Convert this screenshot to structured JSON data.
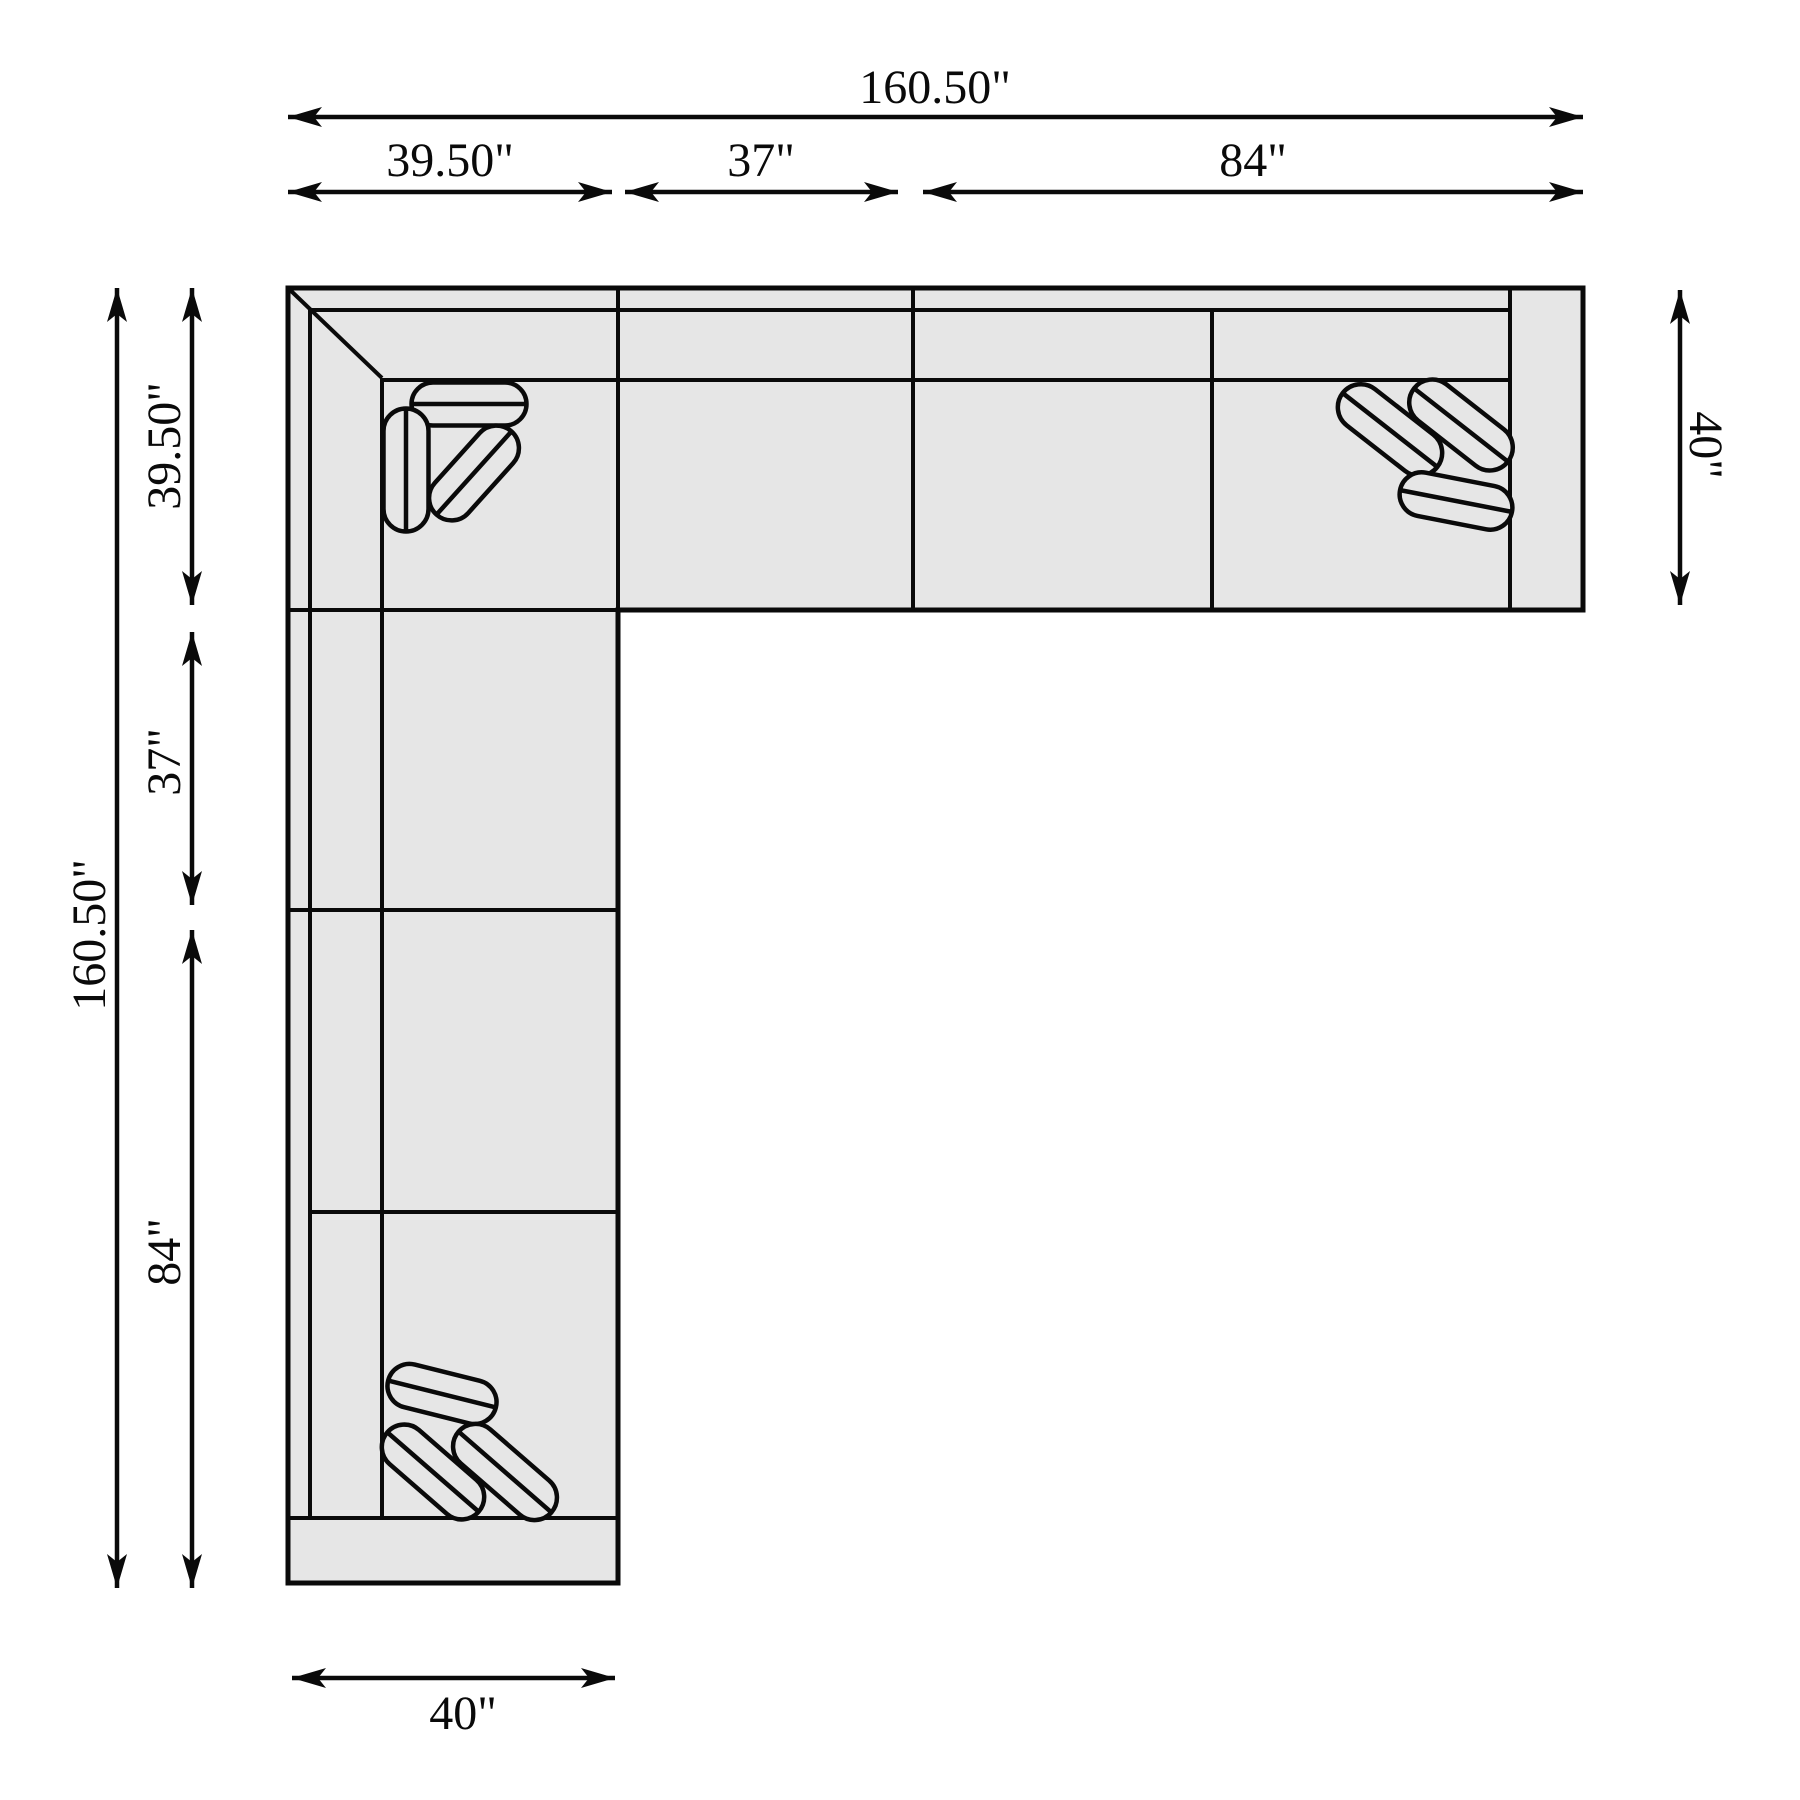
{
  "diagram": {
    "type": "sectional-sofa-floor-plan",
    "canvas": {
      "width": 1800,
      "height": 1800
    },
    "colors": {
      "background": "#ffffff",
      "sofa_fill": "#e6e6e6",
      "line": "#0a0a0a"
    },
    "dimensions": {
      "top_total": "160.50\"",
      "top_segments": [
        "39.50\"",
        "37\"",
        "84\""
      ],
      "left_total": "160.50\"",
      "left_segments": [
        "39.50\"",
        "37\"",
        "84\""
      ],
      "right_depth": "40\"",
      "bottom_width": "40\""
    },
    "geometry": {
      "stroke_outline": 5,
      "stroke_inner": 4,
      "stroke_arrow": 4.5,
      "font_size": 48,
      "outline": [
        [
          288,
          288
        ],
        [
          1583,
          288
        ],
        [
          1583,
          610
        ],
        [
          618,
          610
        ],
        [
          618,
          1583
        ],
        [
          288,
          1583
        ]
      ],
      "diagonal": [
        288,
        288,
        382,
        378
      ],
      "inner_lines": [
        {
          "name": "back-band-top",
          "pts": [
            311,
            310,
            1510,
            310
          ]
        },
        {
          "name": "backrest-front-top",
          "pts": [
            382,
            380,
            1510,
            380
          ]
        },
        {
          "name": "top-strip-bottom",
          "pts": [
            288,
            610,
            1583,
            610
          ]
        },
        {
          "name": "left-37-84-boundary",
          "pts": [
            288,
            910,
            618,
            910
          ]
        },
        {
          "name": "left-seat-divider",
          "pts": [
            310,
            1212,
            618,
            1212
          ]
        },
        {
          "name": "bottom-armrest-inner",
          "pts": [
            288,
            1518,
            618,
            1518
          ]
        },
        {
          "name": "back-band-left",
          "pts": [
            310,
            309,
            310,
            1518
          ]
        },
        {
          "name": "backrest-front-left",
          "pts": [
            382,
            378,
            382,
            1518
          ]
        },
        {
          "name": "corner-module-boundary",
          "pts": [
            618,
            288,
            618,
            1583
          ]
        },
        {
          "name": "top-37-84-boundary",
          "pts": [
            913,
            288,
            913,
            610
          ]
        },
        {
          "name": "top-seat-divider",
          "pts": [
            1212,
            310,
            1212,
            610
          ]
        },
        {
          "name": "right-armrest-inner",
          "pts": [
            1510,
            288,
            1510,
            610
          ]
        }
      ],
      "pillows": [
        {
          "cx": 469,
          "cy": 404,
          "len": 115,
          "w": 43,
          "angle": 0
        },
        {
          "cx": 406,
          "cy": 470,
          "len": 123,
          "w": 45,
          "angle": 90
        },
        {
          "cx": 474,
          "cy": 473,
          "len": 112,
          "w": 45,
          "angle": -48
        },
        {
          "cx": 1390,
          "cy": 430,
          "len": 120,
          "w": 46,
          "angle": 38
        },
        {
          "cx": 1461,
          "cy": 425,
          "len": 119,
          "w": 46,
          "angle": 38
        },
        {
          "cx": 1456,
          "cy": 501,
          "len": 114,
          "w": 44,
          "angle": 11
        },
        {
          "cx": 442,
          "cy": 1394,
          "len": 111,
          "w": 44,
          "angle": 14
        },
        {
          "cx": 433,
          "cy": 1472,
          "len": 121,
          "w": 45,
          "angle": 41
        },
        {
          "cx": 505,
          "cy": 1472,
          "len": 123,
          "w": 45,
          "angle": 41
        }
      ],
      "arrows": [
        {
          "name": "dim-top-total",
          "x1": 288,
          "y1": 117,
          "x2": 1583,
          "y2": 117,
          "label": "160.50\"",
          "lx": 935,
          "ly": 103,
          "rot": 0
        },
        {
          "name": "dim-top-39-50",
          "x1": 288,
          "y1": 192,
          "x2": 612,
          "y2": 192,
          "label": "39.50\"",
          "lx": 450,
          "ly": 176,
          "rot": 0
        },
        {
          "name": "dim-top-37",
          "x1": 625,
          "y1": 192,
          "x2": 898,
          "y2": 192,
          "label": "37\"",
          "lx": 761,
          "ly": 176,
          "rot": 0
        },
        {
          "name": "dim-top-84",
          "x1": 923,
          "y1": 192,
          "x2": 1583,
          "y2": 192,
          "label": "84\"",
          "lx": 1253,
          "ly": 176,
          "rot": 0
        },
        {
          "name": "dim-left-total",
          "x1": 117,
          "y1": 288,
          "x2": 117,
          "y2": 1588,
          "label": "160.50\"",
          "lx": 105,
          "ly": 935,
          "rot": -90
        },
        {
          "name": "dim-left-39-50",
          "x1": 192,
          "y1": 288,
          "x2": 192,
          "y2": 605,
          "label": "39.50\"",
          "lx": 180,
          "ly": 446,
          "rot": -90
        },
        {
          "name": "dim-left-37",
          "x1": 192,
          "y1": 632,
          "x2": 192,
          "y2": 905,
          "label": "37\"",
          "lx": 180,
          "ly": 762,
          "rot": -90
        },
        {
          "name": "dim-left-84",
          "x1": 192,
          "y1": 930,
          "x2": 192,
          "y2": 1588,
          "label": "84\"",
          "lx": 180,
          "ly": 1252,
          "rot": -90
        },
        {
          "name": "dim-right-40",
          "x1": 1680,
          "y1": 290,
          "x2": 1680,
          "y2": 605,
          "label": "40\"",
          "lx": 1690,
          "ly": 445,
          "rot": 90
        },
        {
          "name": "dim-bottom-40",
          "x1": 292,
          "y1": 1678,
          "x2": 615,
          "y2": 1678,
          "label": "40\"",
          "lx": 463,
          "ly": 1729,
          "rot": 0
        }
      ]
    }
  }
}
